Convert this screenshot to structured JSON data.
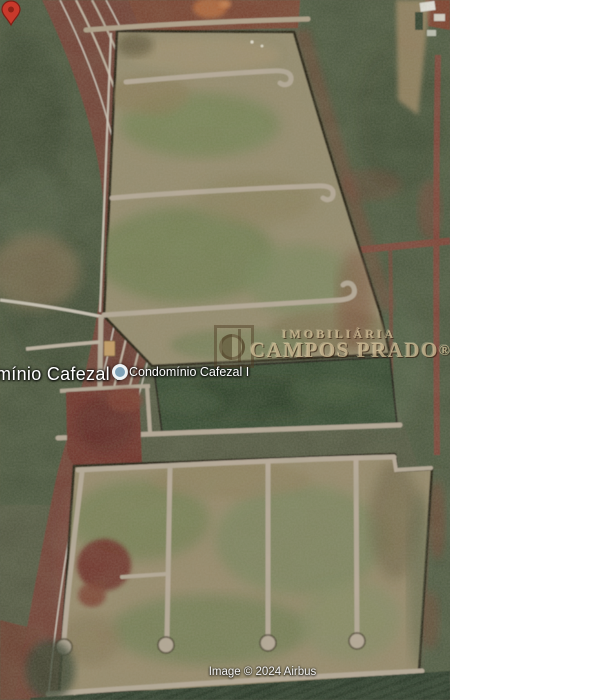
{
  "window": {
    "width": 616,
    "height": 700
  },
  "map_view": {
    "type": "satellite-imagery",
    "large_place_label": "mínio Cafezal I",
    "placemark": {
      "label": "Condomínio Cafezal I"
    },
    "watermark": {
      "line1": "IMOBILIÁRIA",
      "line2": "CAMPOS PRADO",
      "registered_mark": "®"
    },
    "attribution": "Image © 2024 Airbus",
    "colors": {
      "margin_white": "#ffffff",
      "field_green": "#46523a",
      "terrain_tan": "#958a6c",
      "soil_red": "#6f3d33",
      "road_light": "#b8aa99",
      "perimeter_dark": "#231a10",
      "pond_green": "#33462e",
      "crop_green": "#2c3a29",
      "marker_red": "#c8392b",
      "marker_dot_blue": "#7fa2b8",
      "watermark_tan": "#d7c39b",
      "label_white": "#ffffff"
    }
  }
}
